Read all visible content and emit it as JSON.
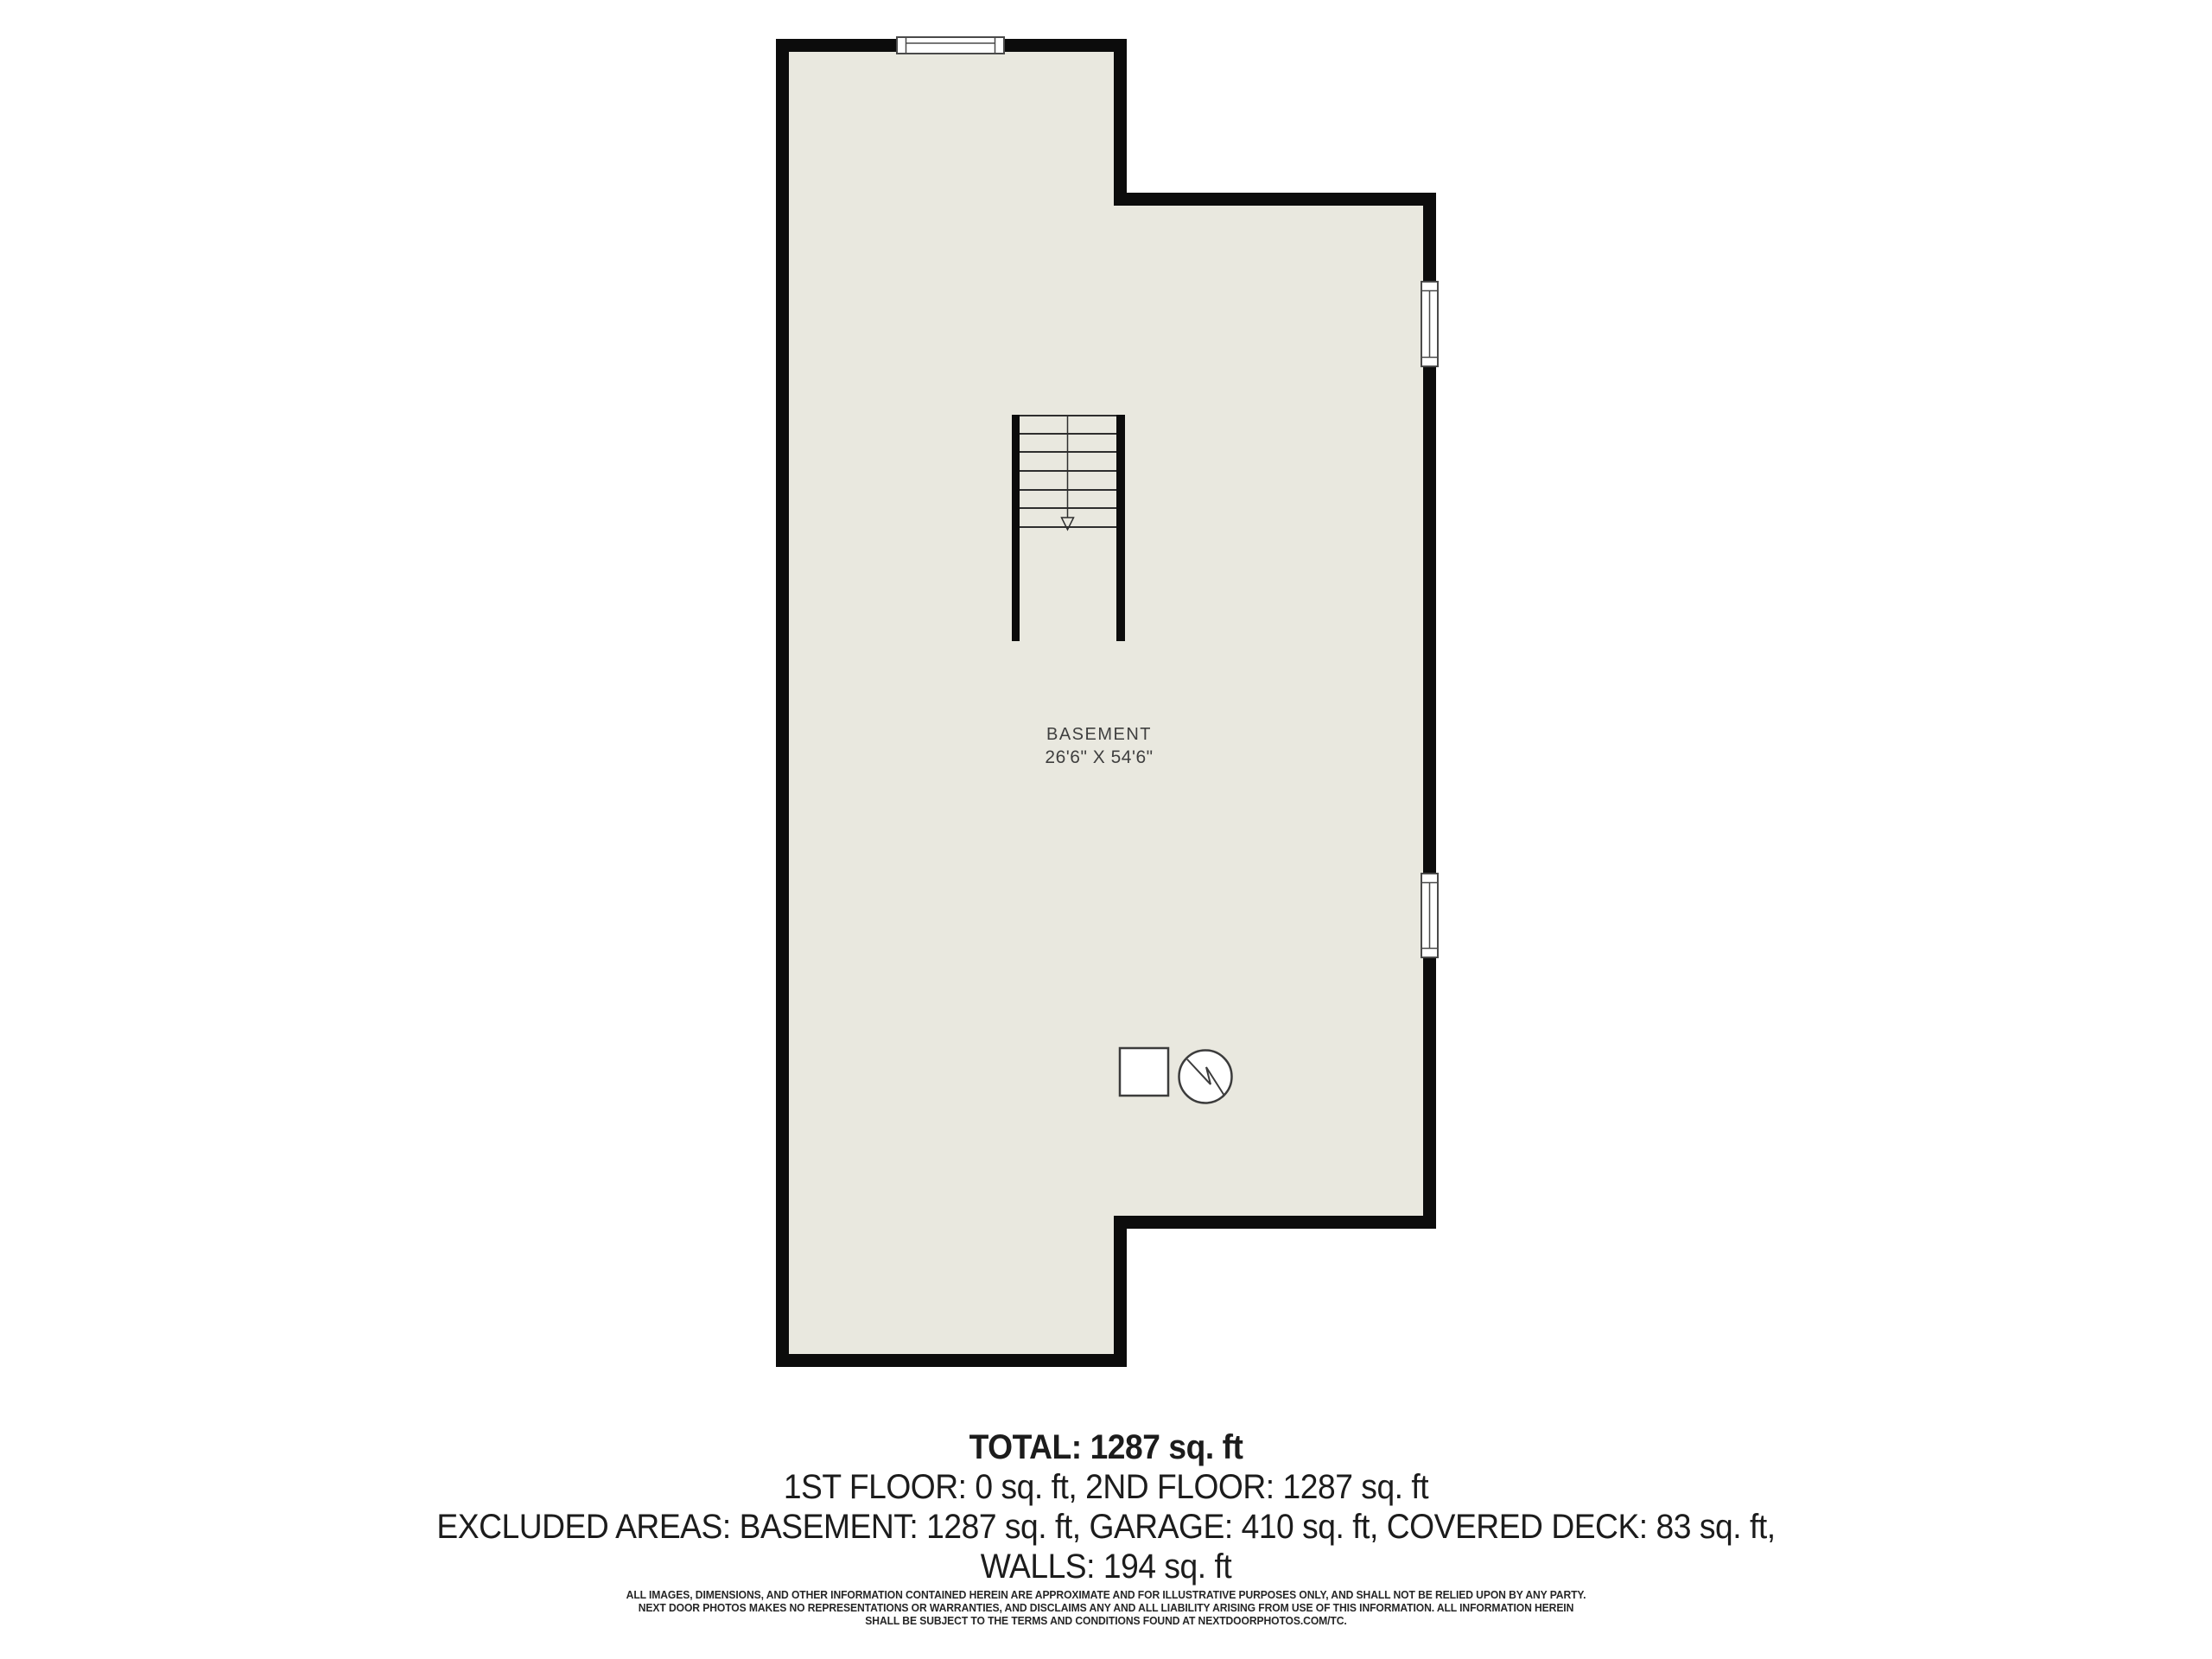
{
  "floorplan": {
    "room_label": "BASEMENT",
    "room_dimensions": "26'6\" X 54'6\""
  },
  "summary": {
    "total": "TOTAL: 1287 sq. ft",
    "floors": "1ST FLOOR: 0 sq. ft, 2ND FLOOR: 1287 sq. ft",
    "excluded": "EXCLUDED AREAS: BASEMENT: 1287 sq. ft, GARAGE: 410 sq. ft, COVERED DECK: 83 sq. ft,",
    "walls": "WALLS: 194 sq. ft"
  },
  "disclaimer": {
    "line1": "ALL IMAGES, DIMENSIONS, AND OTHER INFORMATION CONTAINED HEREIN ARE APPROXIMATE AND FOR ILLUSTRATIVE PURPOSES ONLY, AND SHALL NOT BE RELIED UPON BY ANY PARTY.",
    "line2": "NEXT DOOR PHOTOS MAKES NO REPRESENTATIONS OR WARRANTIES, AND DISCLAIMS ANY AND ALL LIABILITY ARISING FROM USE OF THIS INFORMATION. ALL INFORMATION HEREIN",
    "line3": "SHALL BE SUBJECT TO THE TERMS AND CONDITIONS FOUND AT NEXTDOORPHOTOS.COM/TC."
  },
  "symbols": {
    "square": "furnace-symbol",
    "circle": "water-heater-symbol",
    "stairs_arrow": "arrow-down-icon"
  },
  "colors": {
    "bg": "#ffffff",
    "wall": "#0c0c0c",
    "floor": "#e9e8df",
    "stair_line": "#2e2e2e",
    "window_border": "#4a4a4a",
    "window_fill": "#ffffff",
    "symbol_line": "#3c3c3c",
    "label_text": "#3f3f3f",
    "summary_text": "#1c1c1c",
    "disclaimer_text": "#262626"
  }
}
